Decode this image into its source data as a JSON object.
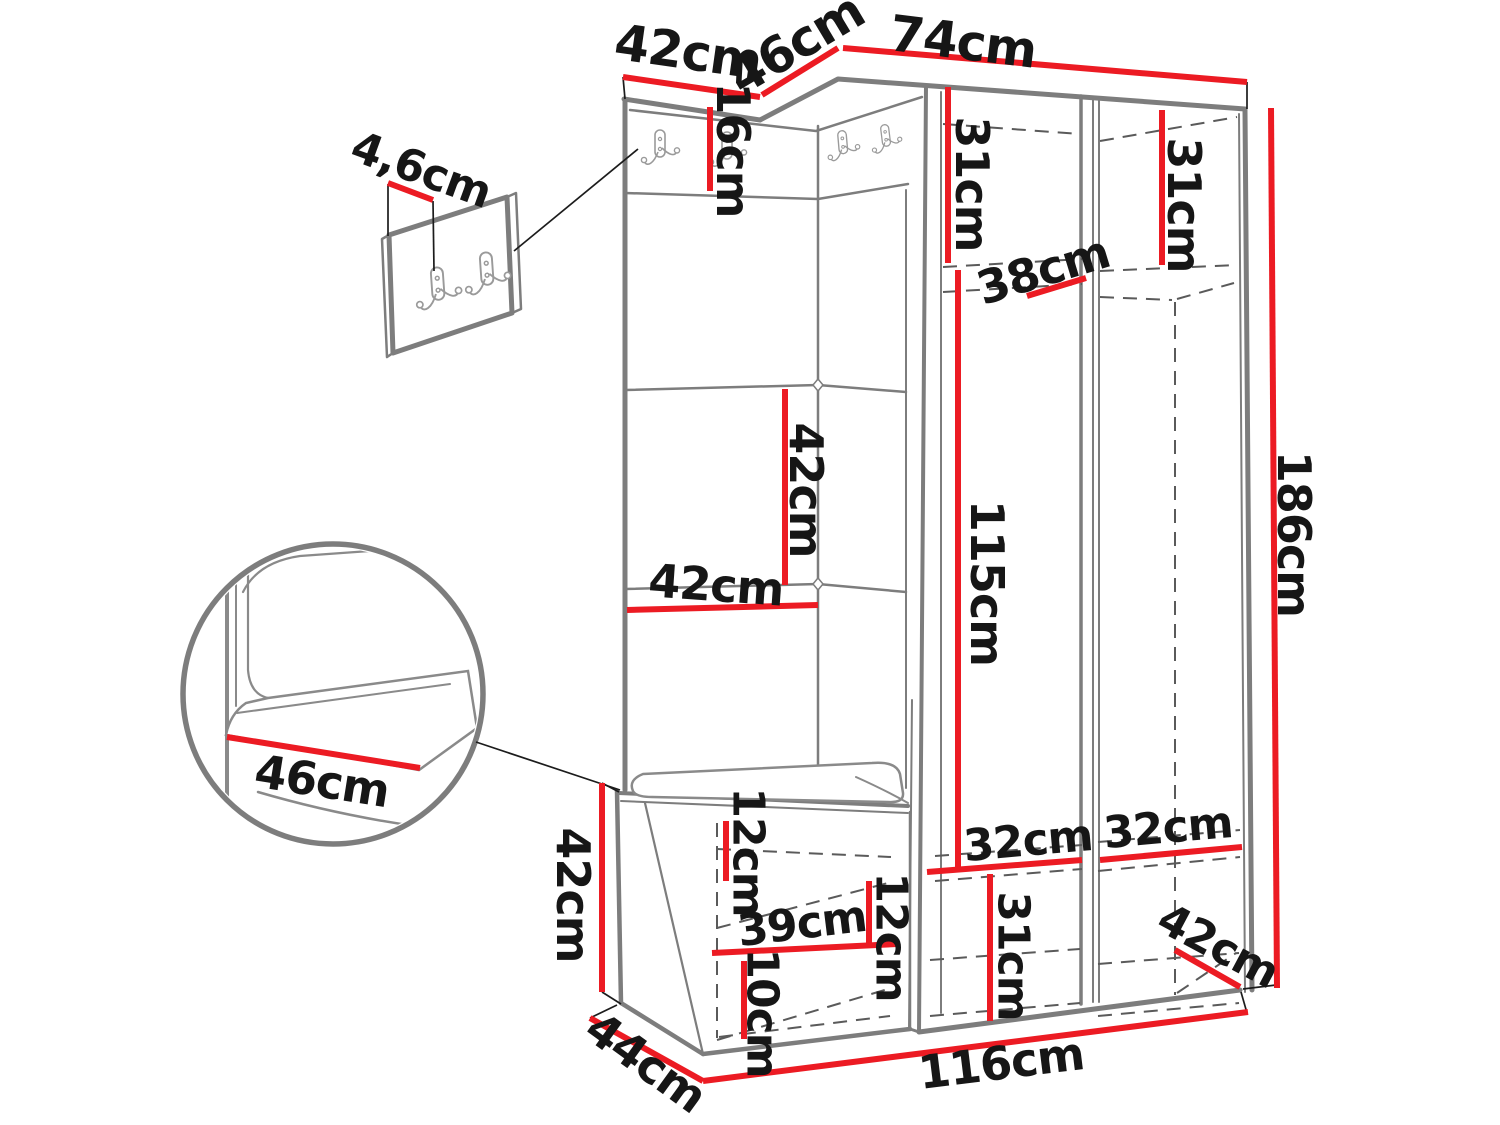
{
  "title": "Hallway furniture set dimension diagram",
  "colors": {
    "dimension": "#ec1b23",
    "outline": "#7d7d7d",
    "hidden": "#5a5a5a",
    "callout": "#1c1c1c",
    "text": "#161616"
  },
  "labels": {
    "top_width_left": "42cm",
    "top_width_middle": "46cm",
    "top_width_right": "74cm",
    "panel_thickness": "4,6cm",
    "hook_strip_height": "16cm",
    "top_shelf_left": "31cm",
    "top_shelf_right": "31cm",
    "shelf_depth": "38cm",
    "panel_height": "42cm",
    "panel_width": "42cm",
    "hanging_height": "115cm",
    "total_height": "186cm",
    "seat_depth": "46cm",
    "bench_height": "42cm",
    "bench_top_offset": "12cm",
    "bench_inner_width": "39cm",
    "bench_side_offset": "12cm",
    "bench_bottom_offset": "10cm",
    "bench_depth": "44cm",
    "total_width": "116cm",
    "compartment_left_width": "32cm",
    "compartment_right_width": "32cm",
    "bottom_section_height": "31cm",
    "bottom_depth": "42cm"
  }
}
